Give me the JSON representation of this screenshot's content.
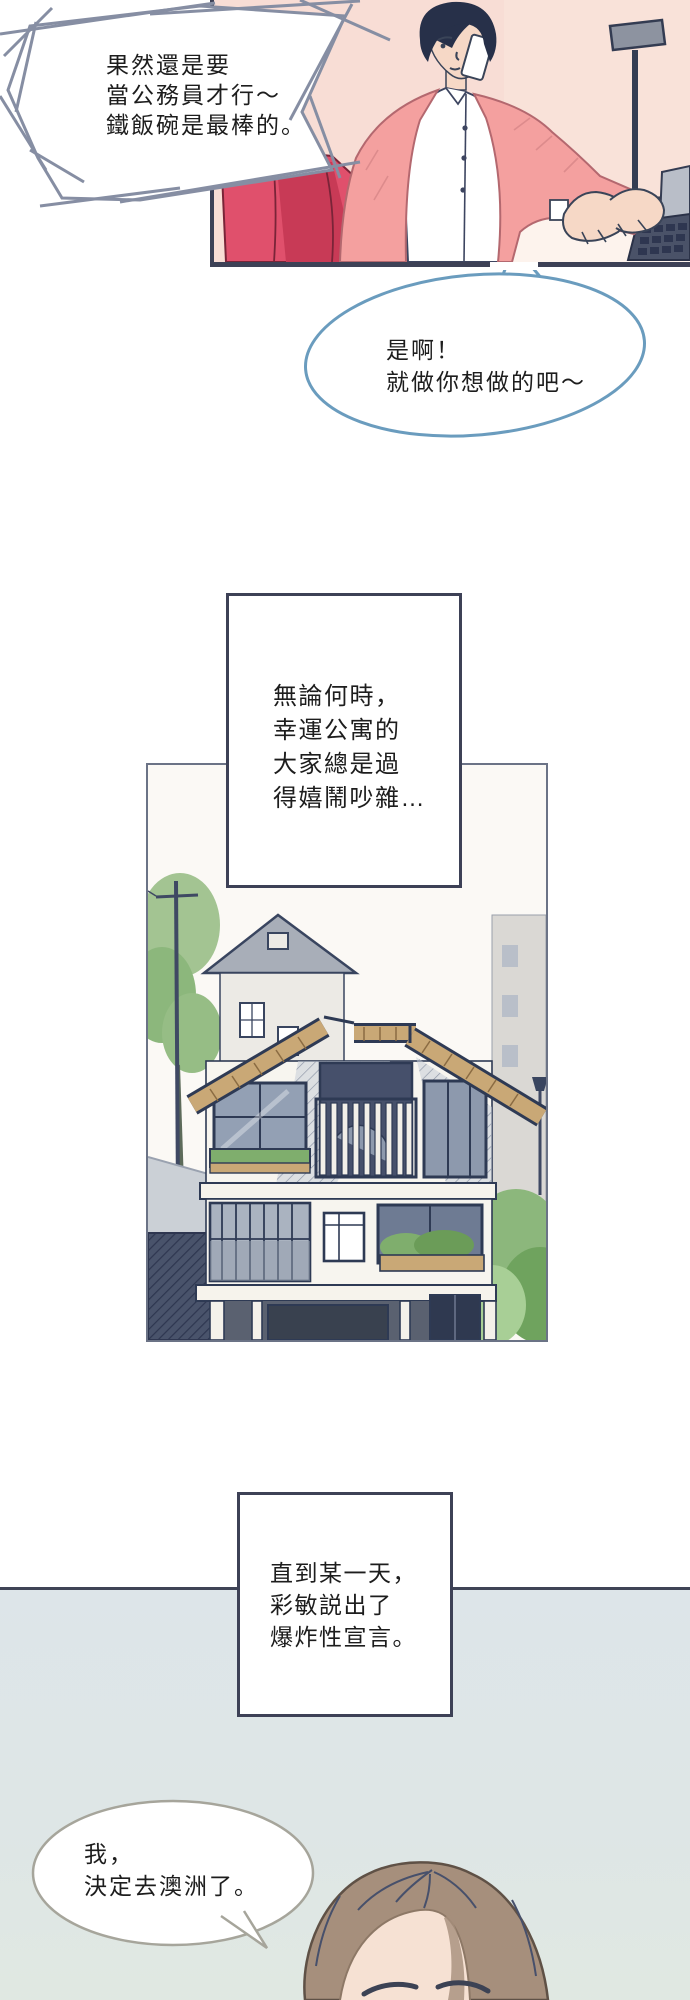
{
  "page": {
    "background": "#ffffff",
    "width": 690,
    "height": 2000
  },
  "panel_top": {
    "scene": "man-talking-on-phone-at-desk",
    "wall_color": "#f8ddd5",
    "border_color": "#3d4156",
    "cardigan_color": "#f4a09f",
    "chair_color": "#e0506c",
    "hair_color": "#273049"
  },
  "bubble_jagged": {
    "stroke_color": "#868ea3",
    "lines": [
      "果然還是要",
      "當公務員才行～",
      "鐵飯碗是最棒的。"
    ]
  },
  "bubble_oval": {
    "stroke_color": "#6a9cbe",
    "lines": [
      "是啊！",
      "就做你想做的吧～"
    ]
  },
  "caption_lucky": {
    "border_color": "#3d4156",
    "lines": [
      "無論何時，",
      "幸運公寓的",
      "大家總是過",
      "得嬉鬧吵雜…"
    ]
  },
  "panel_house": {
    "scene": "three-story-apartment-house-sketch",
    "border_color": "#6b7386",
    "roof_color": "#c9a876",
    "foliage_color": "#8cb77c",
    "line_color": "#2e3a54"
  },
  "caption_announce": {
    "border_color": "#3d4156",
    "lines": [
      "直到某一天，",
      "彩敏説出了",
      "爆炸性宣言。"
    ]
  },
  "panel_bottom": {
    "scene": "woman-head-top",
    "bg_top": "#dde5e9",
    "bg_bottom": "#e0e8e2",
    "border_color": "#3f4456",
    "hair_color": "#a68f7c",
    "skin_color": "#f6e1d3"
  },
  "bubble_australia": {
    "stroke_color": "#a6a59b",
    "lines": [
      "我，",
      "決定去澳洲了。"
    ]
  }
}
